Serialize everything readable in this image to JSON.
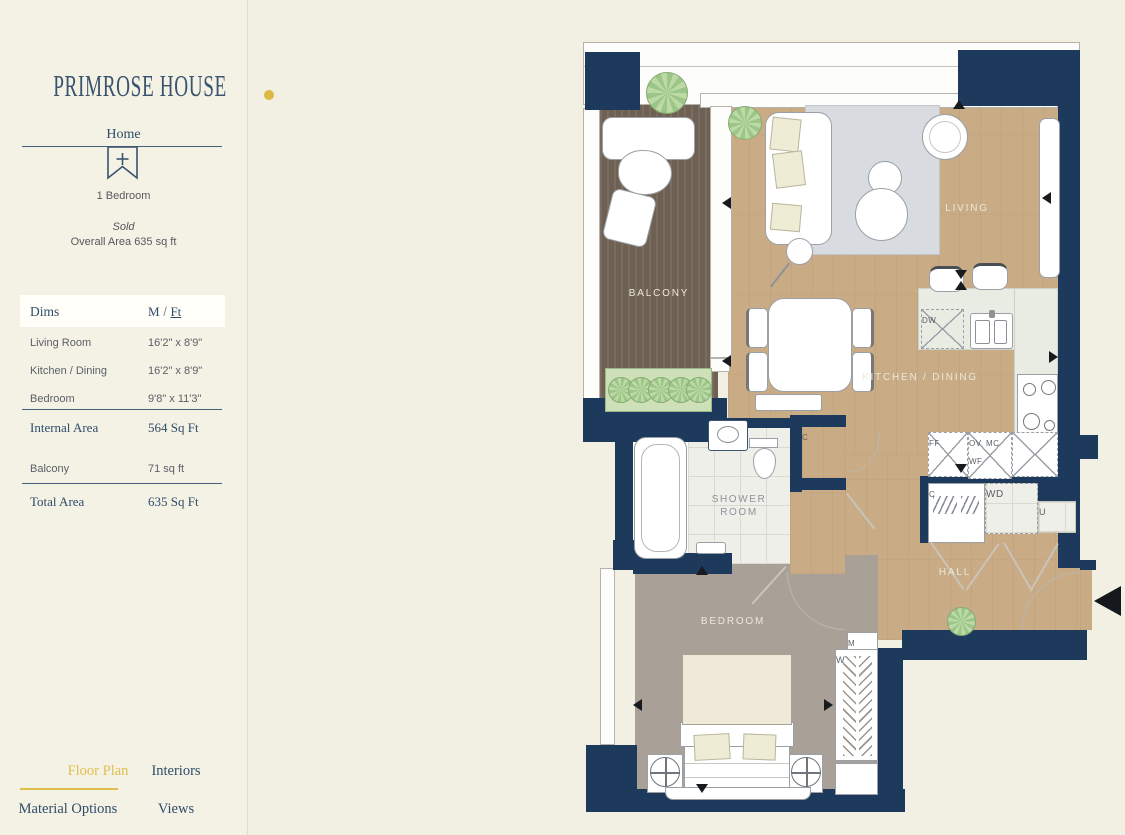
{
  "colors": {
    "page_bg": "#f2efe3",
    "sidebar_bg": "#f4f1e5",
    "wall_navy": "#1d3a5c",
    "accent_gold": "#e0bf4e",
    "text_navy": "#2f4d68",
    "text_gray": "#5a6168"
  },
  "sidebar": {
    "logo_text": "PRIMROSE HOUSE",
    "home_label": "Home",
    "bookmark_icon": "bookmark-plus-icon",
    "unit_type": "1 Bedroom",
    "status": "Sold",
    "overall_area": "Overall Area 635 sq ft",
    "dims": {
      "header_label": "Dims",
      "unit_m": "M",
      "unit_slash": "/",
      "unit_ft": "Ft",
      "rows": [
        {
          "label": "Living Room",
          "value": "16'2\" x 8'9\""
        },
        {
          "label": "Kitchen / Dining",
          "value": "16'2\" x 8'9\""
        },
        {
          "label": "Bedroom",
          "value": "9'8\" x 11'3\""
        }
      ],
      "internal_area": {
        "label": "Internal Area",
        "value": "564 Sq Ft"
      },
      "balcony": {
        "label": "Balcony",
        "value": "71 sq ft"
      },
      "total_area": {
        "label": "Total Area",
        "value": "635 Sq Ft"
      }
    },
    "nav": [
      {
        "label": "Floor Plan"
      },
      {
        "label": "Interiors"
      },
      {
        "label": "Material Options"
      },
      {
        "label": "Views"
      }
    ]
  },
  "floorplan": {
    "rooms": {
      "balcony": "BALCONY",
      "living": "LIVING",
      "kitchen_dining": "KITCHEN / DINING",
      "shower_room": "SHOWER ROOM",
      "hall": "HALL",
      "bedroom": "BEDROOM"
    },
    "fixtures": {
      "dishwasher": "DW",
      "fridge_freezer": "FF",
      "oven": "OV",
      "microwave": "MC",
      "wine_fridge": "WF",
      "washer_dryer": "WD",
      "closet_hall": "C",
      "closet_shower": "C",
      "utility": "U",
      "meter": "M",
      "wardrobe": "W"
    }
  }
}
